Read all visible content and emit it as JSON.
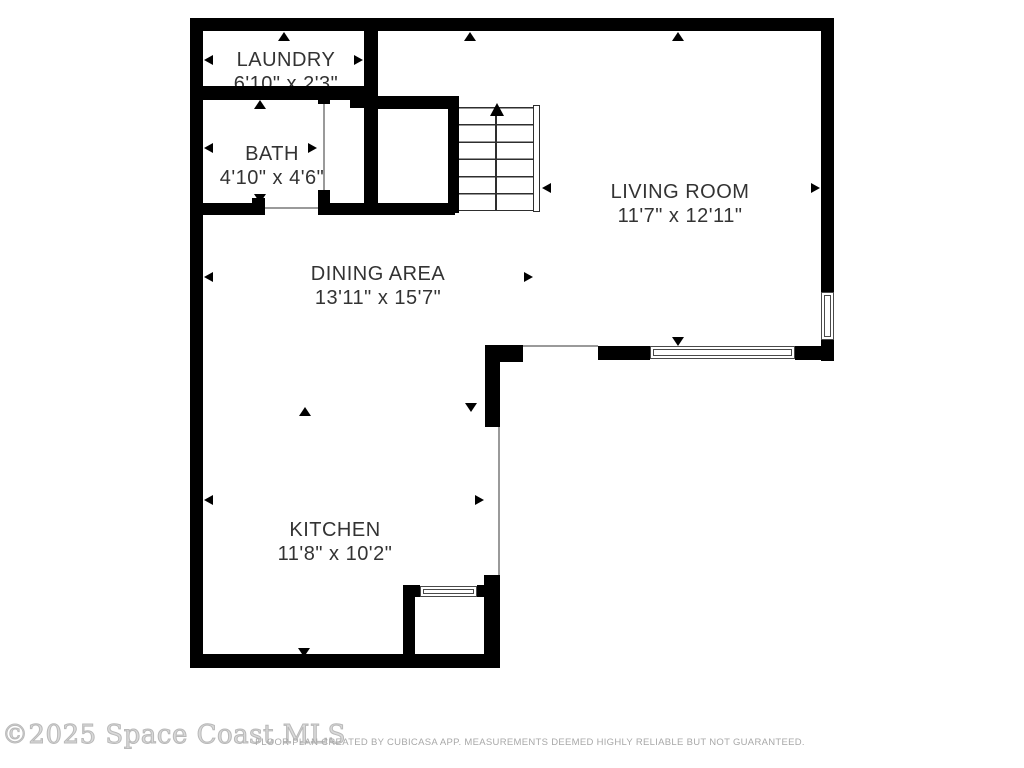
{
  "floorplan": {
    "rooms": [
      {
        "id": "laundry",
        "name": "LAUNDRY",
        "dims": "6'10\" x 2'3\""
      },
      {
        "id": "bath",
        "name": "BATH",
        "dims": "4'10\" x 4'6\""
      },
      {
        "id": "living-room",
        "name": "LIVING ROOM",
        "dims": "11'7\" x 12'11\""
      },
      {
        "id": "dining-area",
        "name": "DINING AREA",
        "dims": "13'11\" x 15'7\""
      },
      {
        "id": "kitchen",
        "name": "KITCHEN",
        "dims": "11'8\" x 10'2\""
      }
    ],
    "stairs": {
      "direction": "up"
    },
    "colors": {
      "wall": "#000000",
      "label_text": "#333333",
      "thin_line": "#9a9a9a",
      "window_frame": "#4a4a4a"
    }
  },
  "watermark": {
    "text": "©2025 Space Coast MLS"
  },
  "footer": {
    "text": "FLOOR PLAN CREATED BY CUBICASA APP. MEASUREMENTS DEEMED HIGHLY RELIABLE BUT NOT GUARANTEED."
  }
}
